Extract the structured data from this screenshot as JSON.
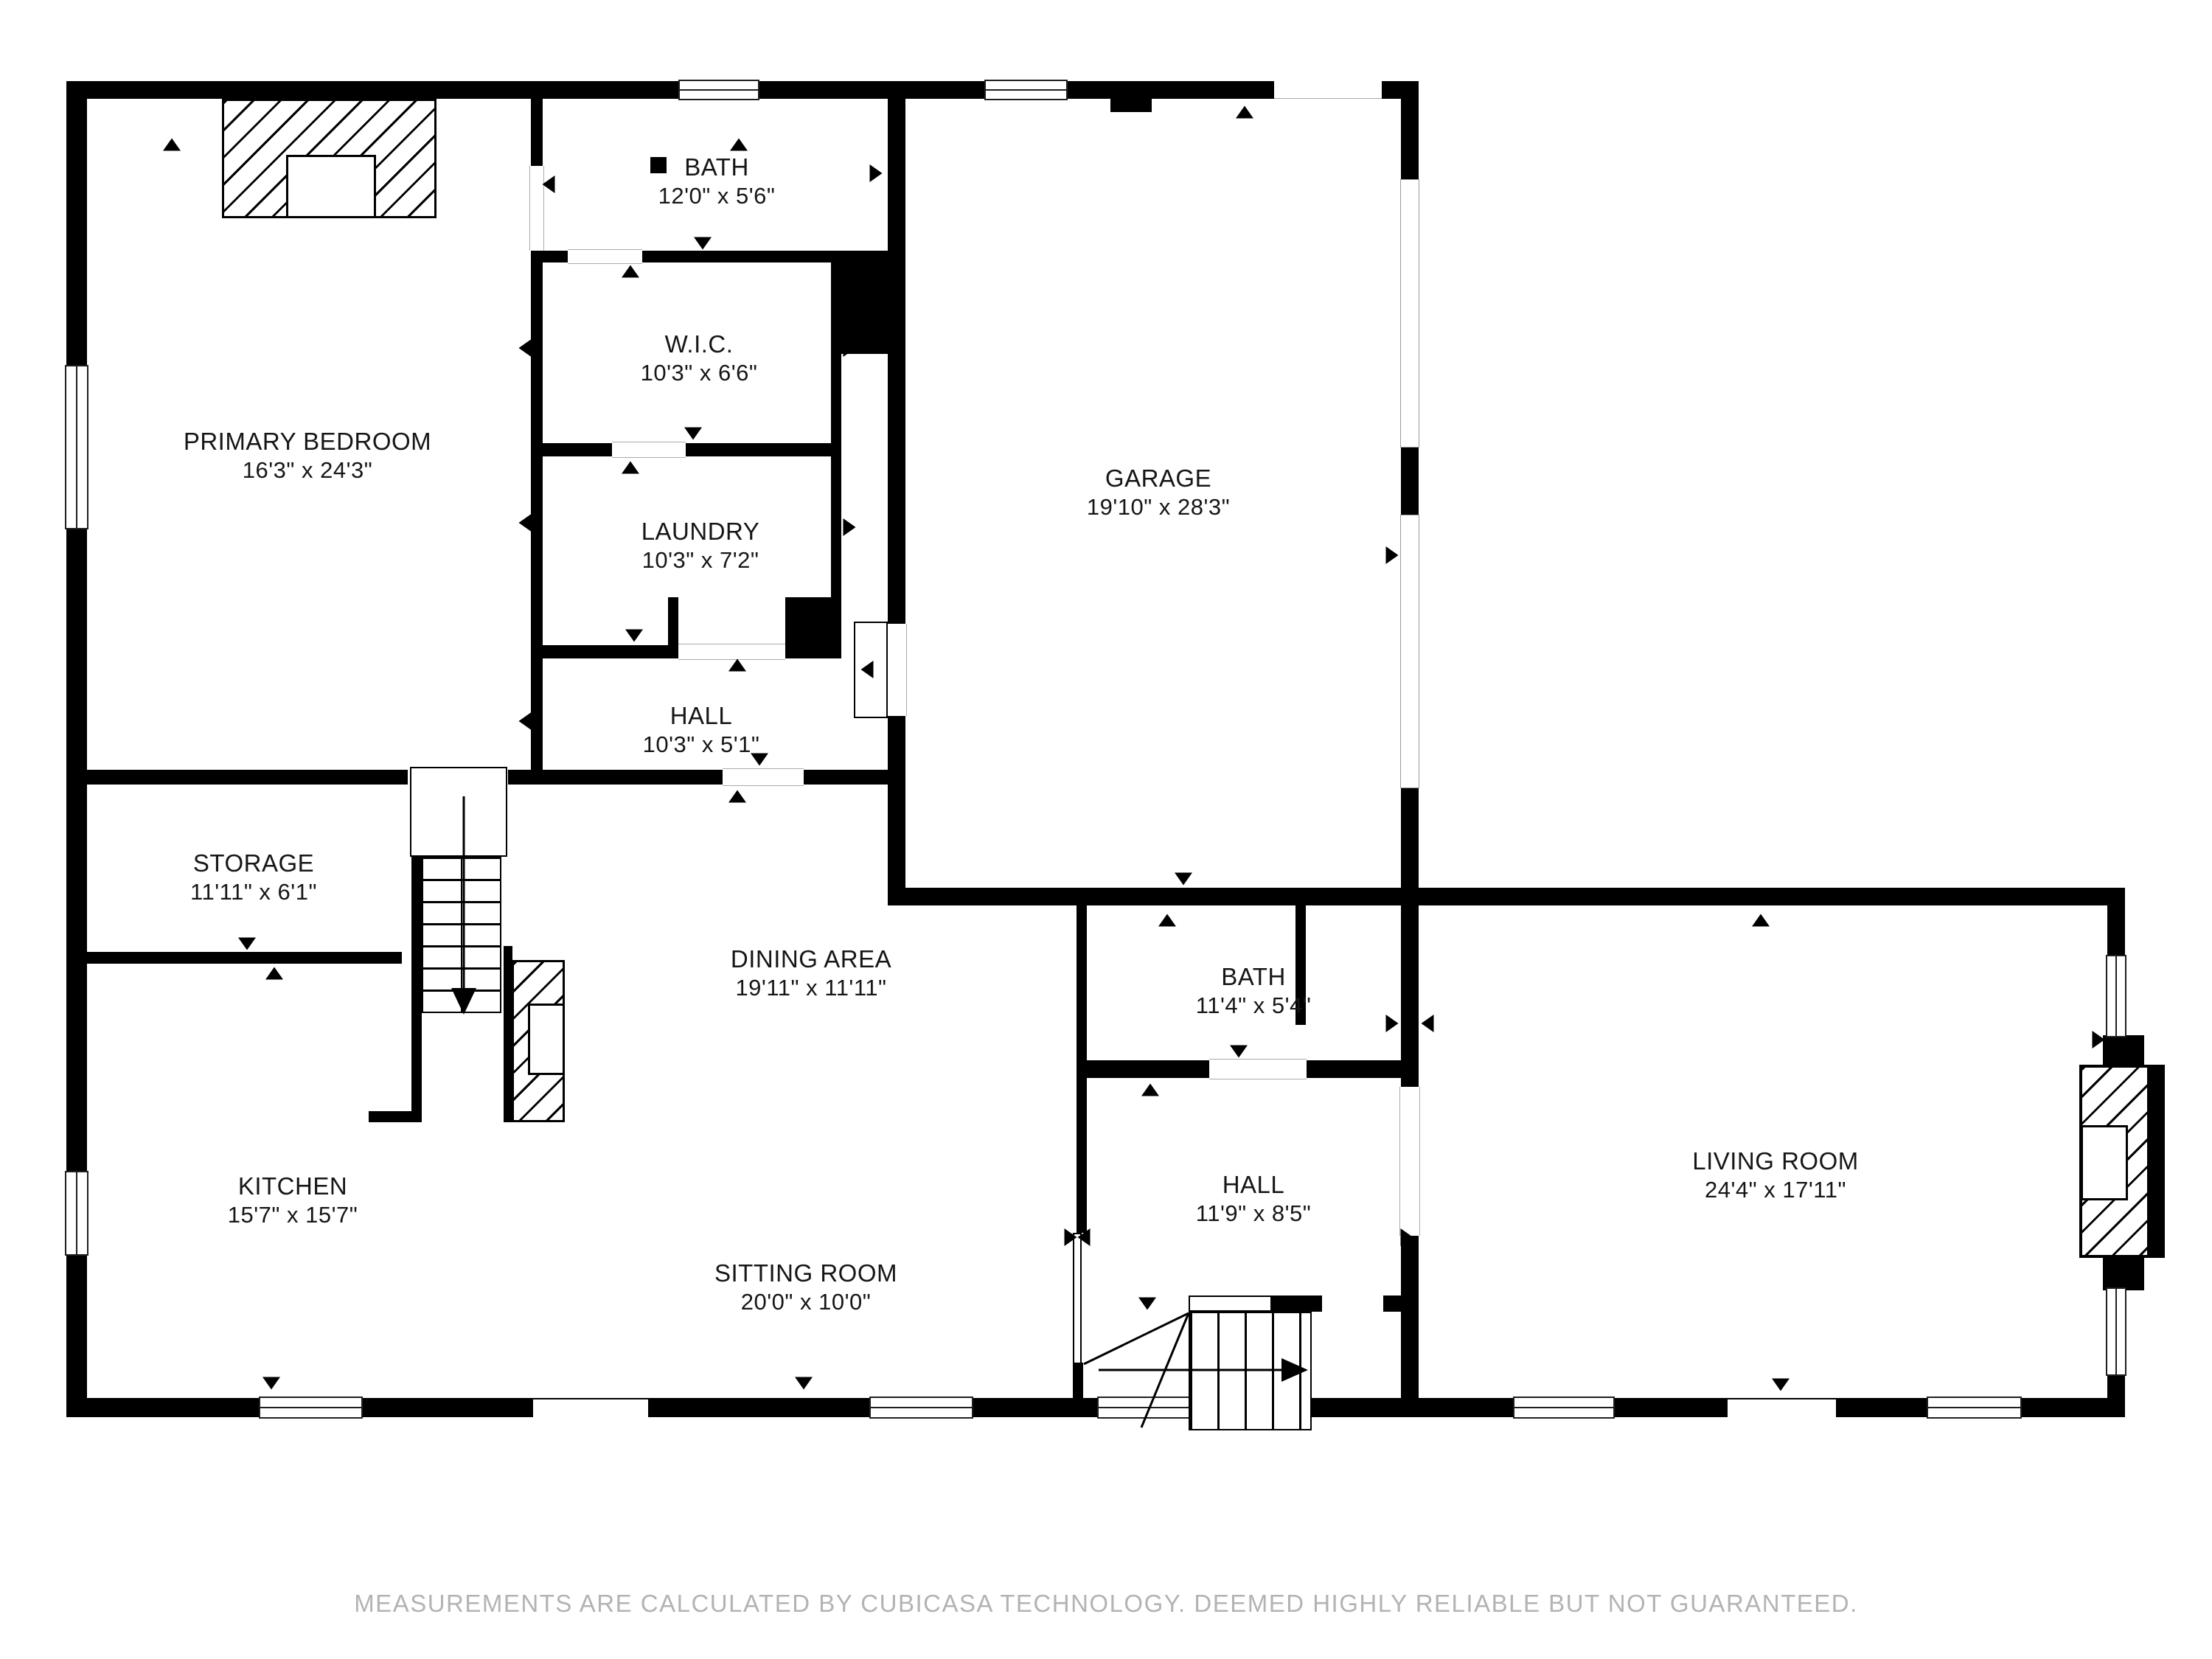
{
  "floorplan": {
    "rooms": [
      {
        "name": "PRIMARY BEDROOM",
        "dims": "16'3\" x 24'3\""
      },
      {
        "name": "BATH",
        "dims": "12'0\" x 5'6\""
      },
      {
        "name": "W.I.C.",
        "dims": "10'3\" x 6'6\""
      },
      {
        "name": "LAUNDRY",
        "dims": "10'3\" x 7'2\""
      },
      {
        "name": "HALL",
        "dims": "10'3\" x 5'1\""
      },
      {
        "name": "GARAGE",
        "dims": "19'10\" x 28'3\""
      },
      {
        "name": "STORAGE",
        "dims": "11'11\" x 6'1\""
      },
      {
        "name": "DINING AREA",
        "dims": "19'11\" x 11'11\""
      },
      {
        "name": "BATH",
        "dims": "11'4\" x 5'4\""
      },
      {
        "name": "HALL",
        "dims": "11'9\" x 8'5\""
      },
      {
        "name": "KITCHEN",
        "dims": "15'7\" x 15'7\""
      },
      {
        "name": "SITTING ROOM",
        "dims": "20'0\" x 10'0\""
      },
      {
        "name": "LIVING ROOM",
        "dims": "24'4\" x 17'11\""
      }
    ],
    "footer": "MEASUREMENTS ARE CALCULATED BY CUBICASA TECHNOLOGY. DEEMED HIGHLY RELIABLE BUT NOT GUARANTEED.",
    "colors": {
      "wall": "#000000",
      "background": "#ffffff",
      "footer_text": "#b3b3b3"
    }
  }
}
